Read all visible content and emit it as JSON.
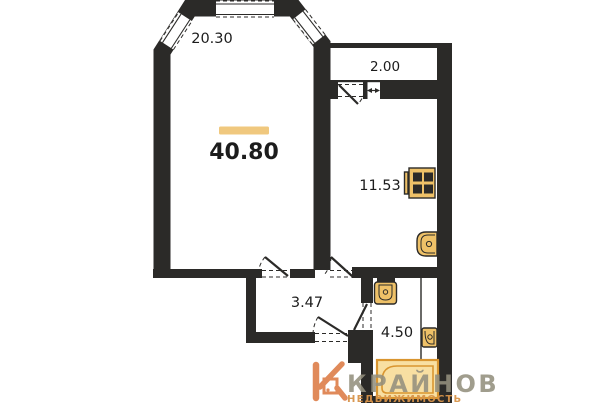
{
  "floorplan": {
    "total_area": "40.80",
    "rooms": {
      "living": {
        "area": "20.30"
      },
      "balcony": {
        "area": "2.00"
      },
      "kitchen": {
        "area": "11.53"
      },
      "hallway": {
        "area": "3.47"
      },
      "bathroom": {
        "area": "4.50"
      }
    },
    "colors": {
      "wall": "#2b2a28",
      "highlight_bar": "#f0c87e",
      "fixture_fill": "#eec168",
      "fixture_accent": "#d9952f",
      "bathtub_fill": "#f8dfa2"
    },
    "icons": [
      "stove-icon",
      "kitchen-sink-icon",
      "toilet-icon",
      "bath-sink-icon",
      "bathtub-icon",
      "dimension-arrow-icon",
      "window-icon",
      "door-swing-icon"
    ]
  },
  "watermark": {
    "brand": "КРАЙНОВ",
    "subtitle": "НЕДВИЖИМОСТЬ",
    "brand_color": "#94907e",
    "subtitle_color": "#d8944a",
    "mark_color": "#e08a5a"
  }
}
